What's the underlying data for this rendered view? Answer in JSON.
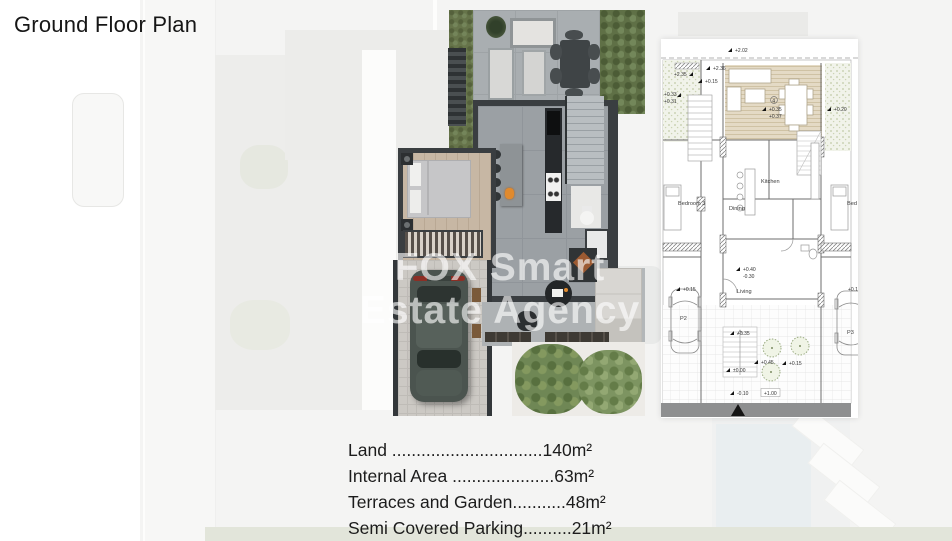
{
  "page": {
    "title": "Ground Floor Plan",
    "watermark_line1": "FOX Smart",
    "watermark_line2": "Estate Agency"
  },
  "area_summary": {
    "items": [
      {
        "label": "Land ",
        "dots": "...............................",
        "value": "140m²"
      },
      {
        "label": "Internal Area ",
        "dots": ".....................",
        "value": "63m²"
      },
      {
        "label": "Terraces and Garden",
        "dots": "...........",
        "value": "48m²"
      },
      {
        "label": "Semi Covered Parking",
        "dots": "..........",
        "value": "21m²"
      }
    ]
  },
  "tech_plan": {
    "unit_number": "4",
    "rooms": {
      "kitchen": "Kitchen",
      "dining": "Dining",
      "bedroom3": "Bedroom 3",
      "bed": "Bed",
      "living": "Living"
    },
    "parking": {
      "p2": "P2",
      "p3": "P3"
    },
    "elevations": [
      "+2.02",
      "+2.36",
      "+2.35",
      "+0.15",
      "+0.33",
      "+0.31",
      "+0.35",
      "+0.37",
      "+0.20",
      "+0.40",
      "-0.30",
      "+0.15",
      "+0.15",
      "+0.35",
      "+0.45",
      "+0.15",
      "±0.00",
      "-0.10",
      "+1.00"
    ]
  },
  "colors": {
    "watermark_text": "#ffffff",
    "hedge_green": "#66744a",
    "wall_dark": "#3a3e41",
    "deck_tan": "#e3d9c4",
    "north_bar_gray": "#8e8f90"
  }
}
